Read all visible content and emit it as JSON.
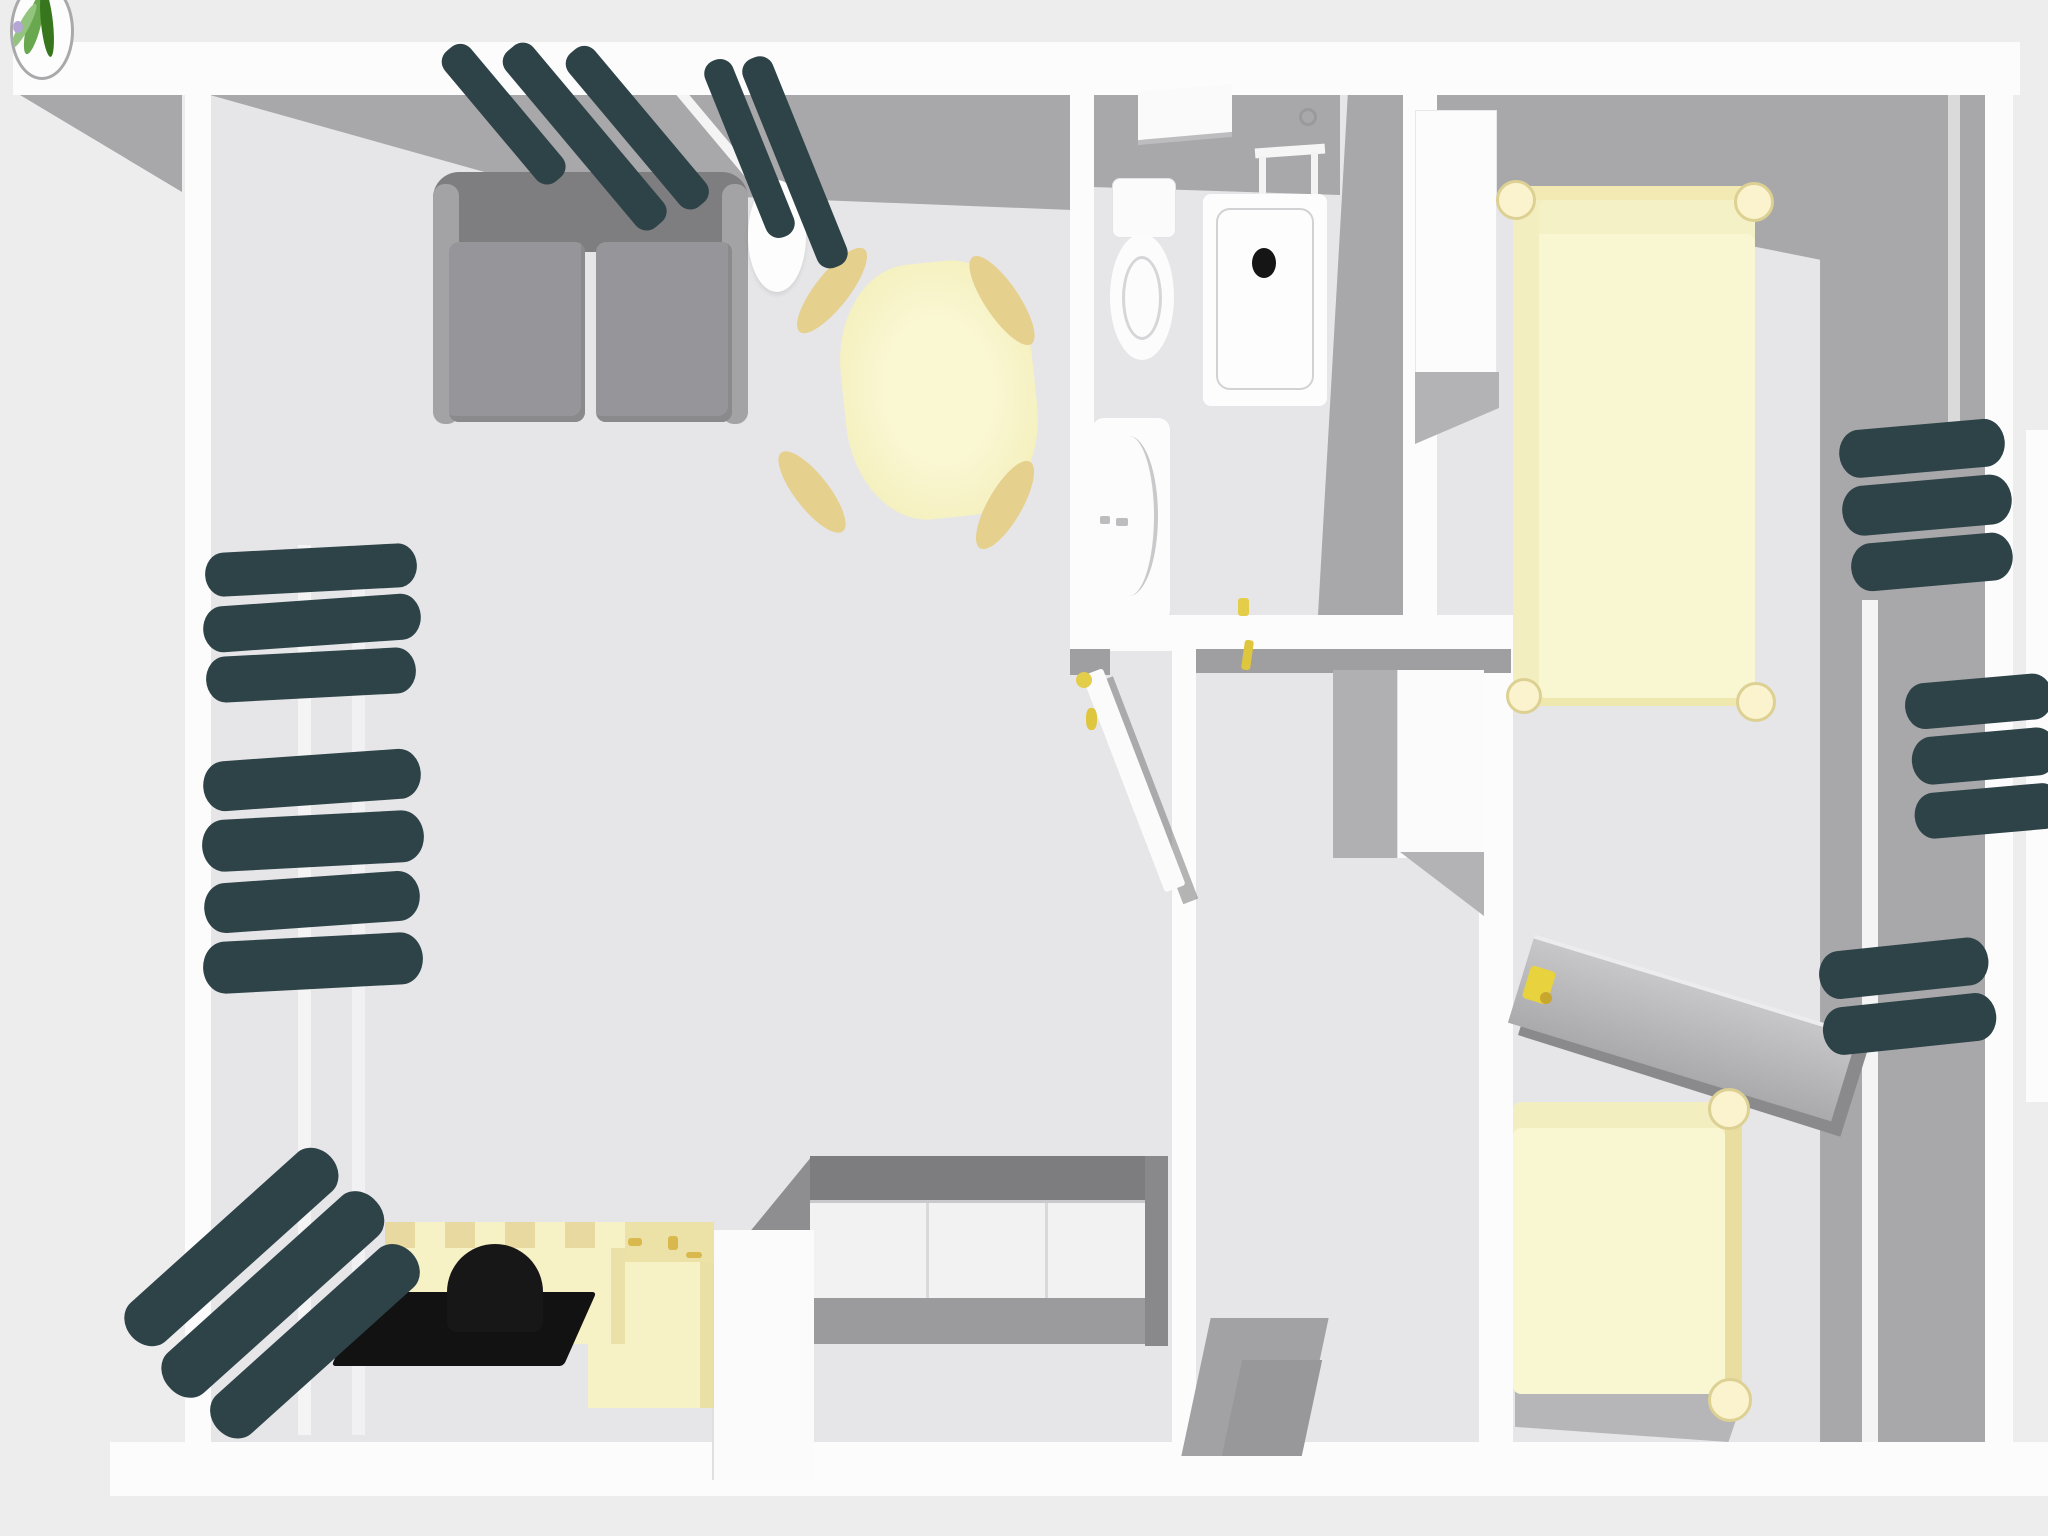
{
  "view": {
    "title": "3D home floor plan - overhead view",
    "interaction": "orbit-drag-viewport"
  },
  "palette": {
    "background": "#ededee",
    "floor": "#e6e6e8",
    "wall": "#fcfcfc",
    "wall_shadow": "#a8a8aa",
    "curtain_teal": "#2e4348",
    "furniture_cream": "#f7f1c6",
    "bed_cream": "#f9f6d2",
    "accent_yellow": "#e4cd49",
    "counter_gray": "#7d7d7f",
    "sofa_gray": "#8e8e90",
    "black": "#141414"
  },
  "rooms": {
    "living": {
      "title": "Living room"
    },
    "bathroom": {
      "title": "Bathroom"
    },
    "hallway": {
      "title": "Hallway"
    },
    "bedroom": {
      "title": "Bedroom"
    }
  },
  "furniture": {
    "plant_icon": {
      "title": "Potted plant icon"
    },
    "sofa": {
      "title": "Grey two-seater sofa"
    },
    "floor_lamp": {
      "title": "White floor lamp"
    },
    "dining_table": {
      "title": "Round dining table"
    },
    "dining_chair": {
      "title": "Dining chair"
    },
    "kitchen_counter": {
      "title": "Kitchen counter with cabinets"
    },
    "tall_cabinet": {
      "title": "Tall kitchen cabinet"
    },
    "sink_cabinet": {
      "title": "Sink cabinet with brass taps"
    },
    "sideboard": {
      "title": "Cream sideboard with tiled top"
    },
    "pet_bed": {
      "title": "Black pet bed on mat"
    },
    "toilet": {
      "title": "Toilet"
    },
    "shower": {
      "title": "Shower tray with drain"
    },
    "washbasin": {
      "title": "Washbasin"
    },
    "wall_shelf": {
      "title": "Bathroom wall shelf"
    },
    "towel_stand": {
      "title": "Towel stand"
    },
    "wardrobe": {
      "title": "White wardrobe"
    },
    "bed_double": {
      "title": "Double bed with corner posts"
    },
    "bed_single": {
      "title": "Single bed with corner posts"
    },
    "desk": {
      "title": "Desk"
    },
    "desk_lamp": {
      "title": "Yellow desk lamp"
    },
    "hall_cabinet": {
      "title": "Hallway cabinet"
    },
    "doormat": {
      "title": "Entry doormat"
    },
    "door_open": {
      "title": "Open interior door"
    },
    "curtains": {
      "title": "Dark green curtains"
    },
    "window": {
      "title": "Window"
    }
  }
}
